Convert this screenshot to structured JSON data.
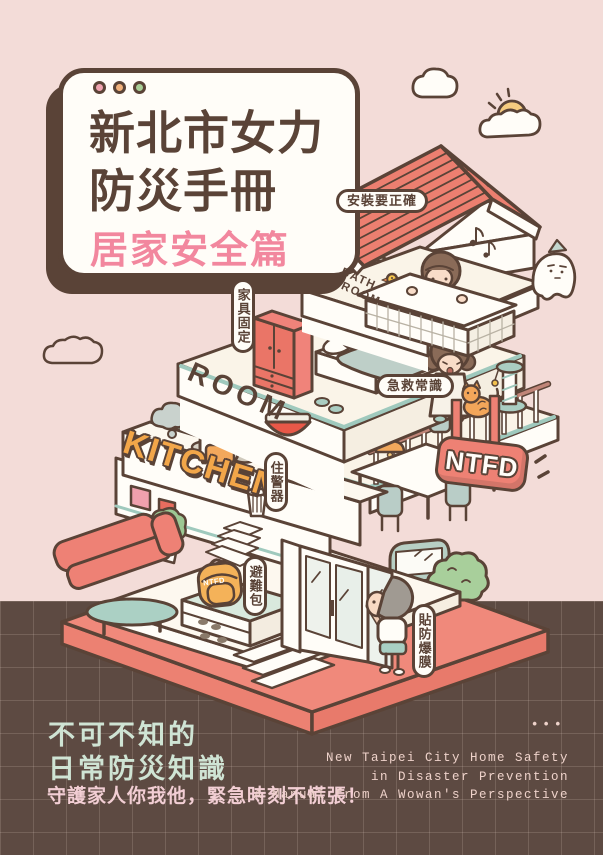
{
  "title_card": {
    "title_line1": "新北市女力",
    "title_line2": "防災手冊",
    "subtitle": "居家安全篇",
    "dot_colors": [
      "#f0a3b0",
      "#f2b27c",
      "#a9cf97"
    ]
  },
  "callouts": {
    "install": "安裝要正確",
    "furniture": "家具固定",
    "first_aid": "急救常識",
    "alarm": "住警器",
    "go_bag": "避難包",
    "film": "貼防爆膜"
  },
  "room_labels": {
    "bathroom_line1": "BATH",
    "bathroom_line2": "ROOM",
    "bedroom": "ROOM",
    "kitchen": "KITCHEN"
  },
  "sign": {
    "text": "NTFD"
  },
  "backpack": {
    "text": "NTFD"
  },
  "footer": {
    "headline_line1": "不可不知的",
    "headline_line2": "日常防災知識",
    "tagline": "守護家人你我他，緊急時刻不慌張！",
    "english_line1": "New Taipei City Home Safety",
    "english_line2": "in Disaster Prevention",
    "english_line3": "A Manual from A Wowan's Perspective",
    "dots": "•••"
  },
  "colors": {
    "background_pink": "#f3dcd8",
    "footer_brown": "#5d4a42",
    "outline_brown": "#5a4337",
    "roof_red": "#ec7f70",
    "base_coral": "#f0897b",
    "subtitle_pink": "#f2879e",
    "mint_text": "#cfe4d4",
    "tagline_pink": "#f2ced4",
    "kitchen_orange": "#f2a649",
    "teal_accent": "#9fc9bd",
    "sign_red": "#ee8174"
  }
}
